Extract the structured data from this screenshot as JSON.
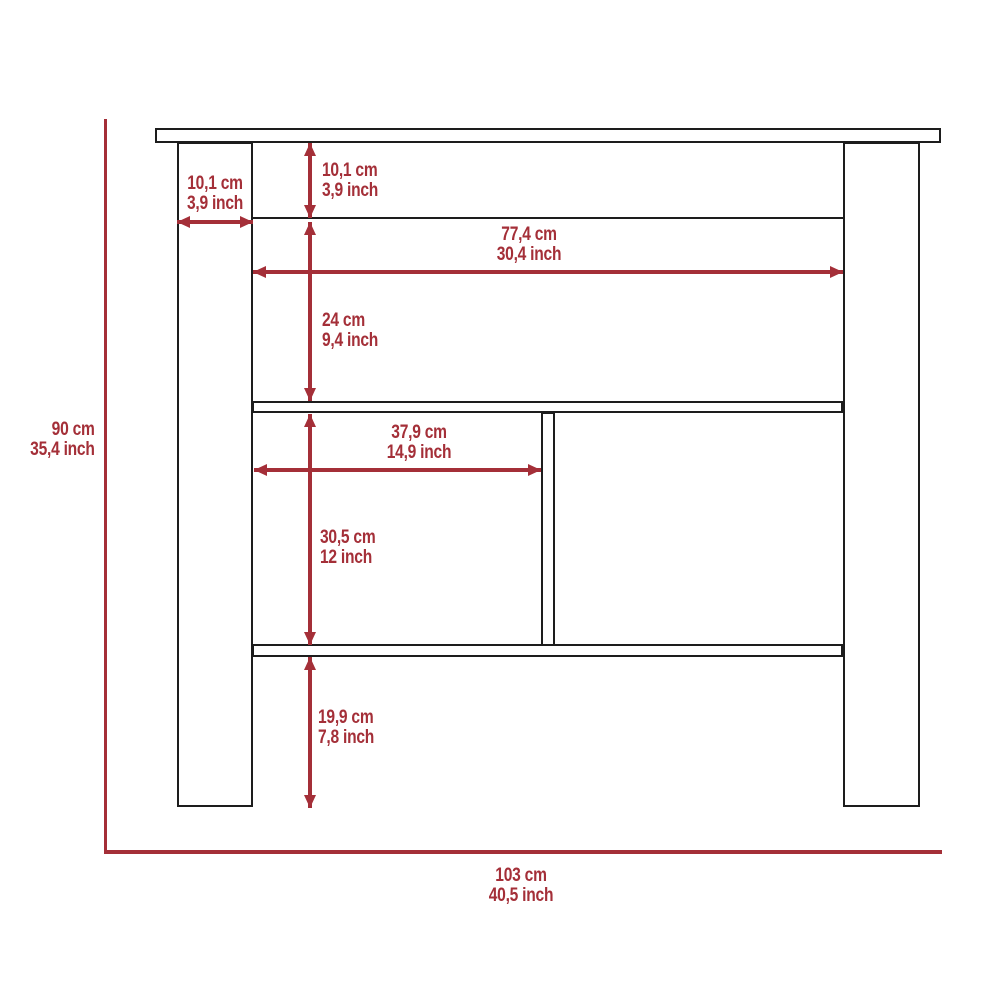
{
  "diagram": {
    "colors": {
      "red": "#a42f38",
      "ink": "#1d1d1d",
      "bg": "#ffffff"
    },
    "labels": {
      "leg_width": {
        "cm": "10,1 cm",
        "inch": "3,9 inch"
      },
      "top_height": {
        "cm": "10,1 cm",
        "inch": "3,9 inch"
      },
      "inner_width": {
        "cm": "77,4 cm",
        "inch": "30,4 inch"
      },
      "upper_height": {
        "cm": "24 cm",
        "inch": "9,4 inch"
      },
      "cubby_width": {
        "cm": "37,9 cm",
        "inch": "14,9 inch"
      },
      "cubby_height": {
        "cm": "30,5 cm",
        "inch": "12 inch"
      },
      "bottom_height": {
        "cm": "19,9 cm",
        "inch": "7,8 inch"
      },
      "overall_height": {
        "cm": "90 cm",
        "inch": "35,4 inch"
      },
      "overall_width": {
        "cm": "103 cm",
        "inch": "40,5 inch"
      }
    }
  }
}
